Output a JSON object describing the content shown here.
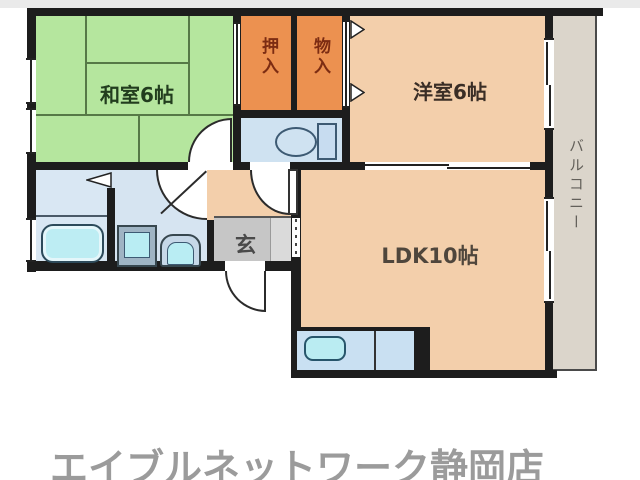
{
  "floorplan": {
    "wall_color": "#1d1d1d",
    "rooms": {
      "washitsu": {
        "label": "和室6帖",
        "color": "#b5e69e",
        "text_color": "#223d1e"
      },
      "oshiire": {
        "label": "押入",
        "color": "#ec9150",
        "text_color": "#7c2c12"
      },
      "monoire": {
        "label": "物入",
        "color": "#ec9150",
        "text_color": "#7c2c12"
      },
      "yoshitsu": {
        "label": "洋室6帖",
        "color": "#f3cfab",
        "text_color": "#3a2e26"
      },
      "ldk": {
        "label": "LDK10帖",
        "color": "#f3cfab",
        "text_color": "#4f463c"
      },
      "genkan": {
        "label": "玄",
        "color": "#c6c6c6",
        "text_color": "#4a4a4a"
      },
      "balcony": {
        "label": "バルコニー",
        "color": "#dbd5cb",
        "text_color": "#63605a"
      },
      "toilet": {
        "color": "#cfe2f1"
      },
      "washroom": {
        "color": "#d6e4f1"
      },
      "bathroom": {
        "color": "#d9e7f3"
      },
      "hallway": {
        "color": "#f3cfab"
      }
    },
    "fixtures": {
      "toilet": "toilet",
      "bathtub": "bathtub",
      "washing_machine": "washing-machine",
      "vanity_sink": "vanity-sink",
      "kitchen_sink": "kitchen-sink"
    },
    "fixture_accent_color": "#b9edf3",
    "footer": {
      "store_name": "エイブルネットワーク静岡店",
      "color": "#9b9b9b"
    }
  }
}
